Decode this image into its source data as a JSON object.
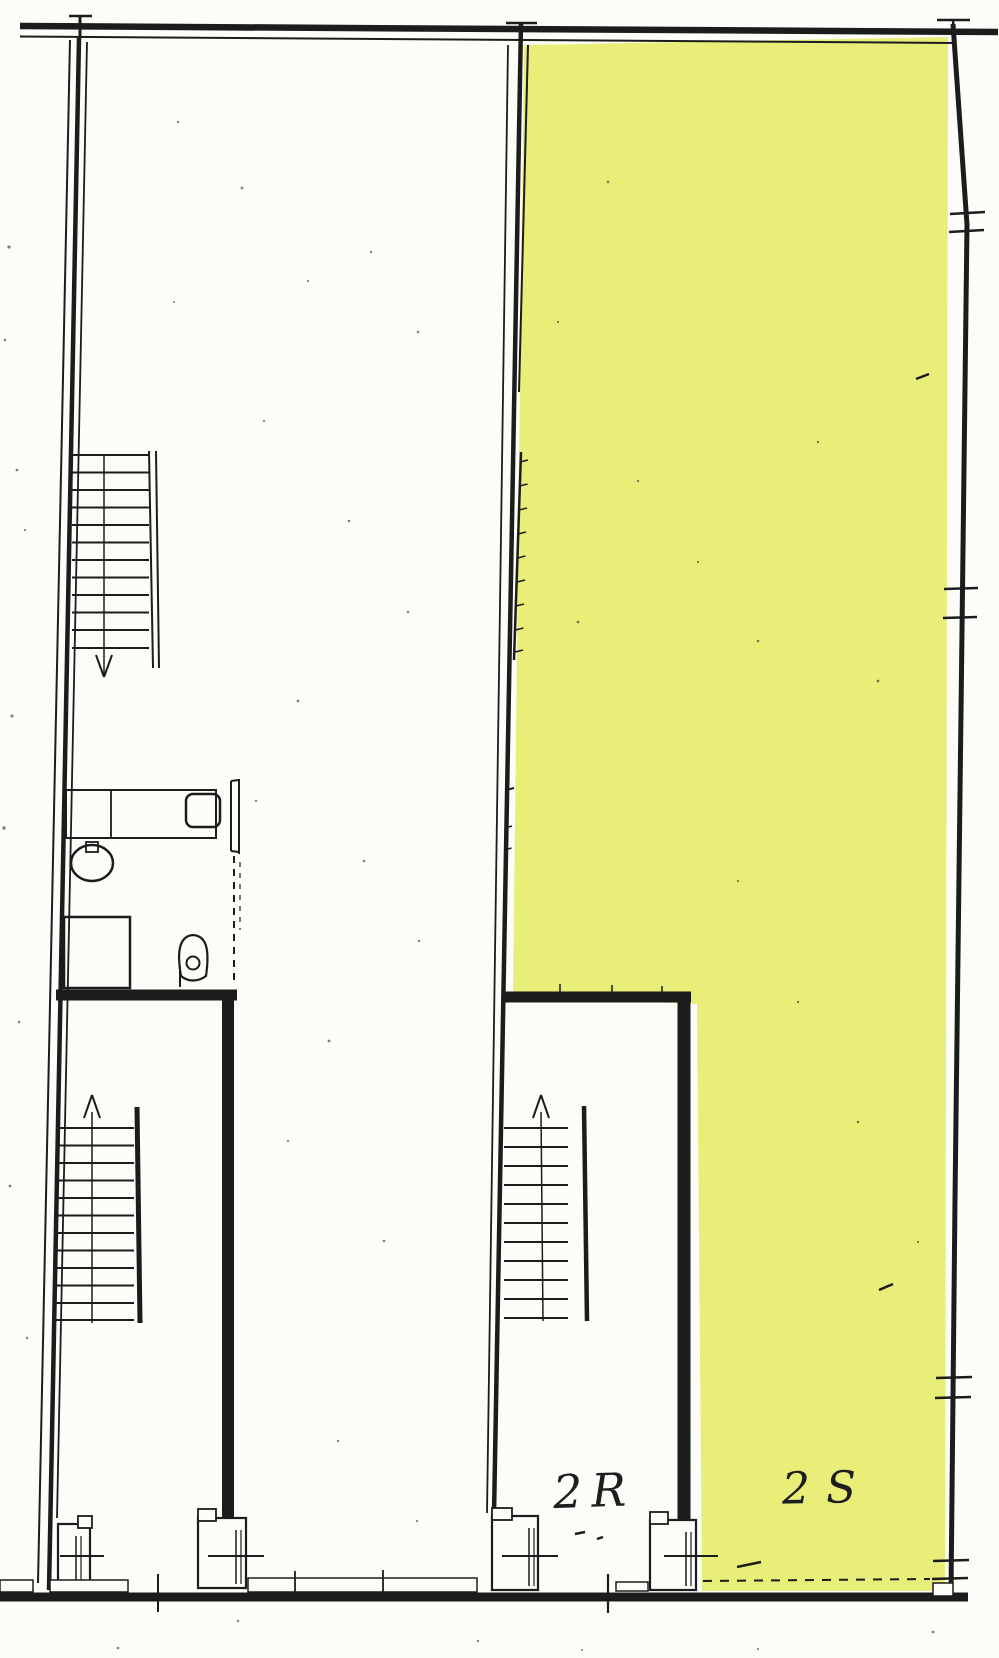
{
  "labels": {
    "unit_left": "2R",
    "unit_right": "2S"
  },
  "colors": {
    "highlight": "#e9ee79",
    "ink": "#1c1c1c",
    "paper": "#fcfcf9"
  },
  "icons": {
    "upper_left_stair_direction": "arrow-down-icon",
    "lower_left_stair_direction": "arrow-up-icon",
    "middle_stair_direction": "arrow-up-icon"
  }
}
